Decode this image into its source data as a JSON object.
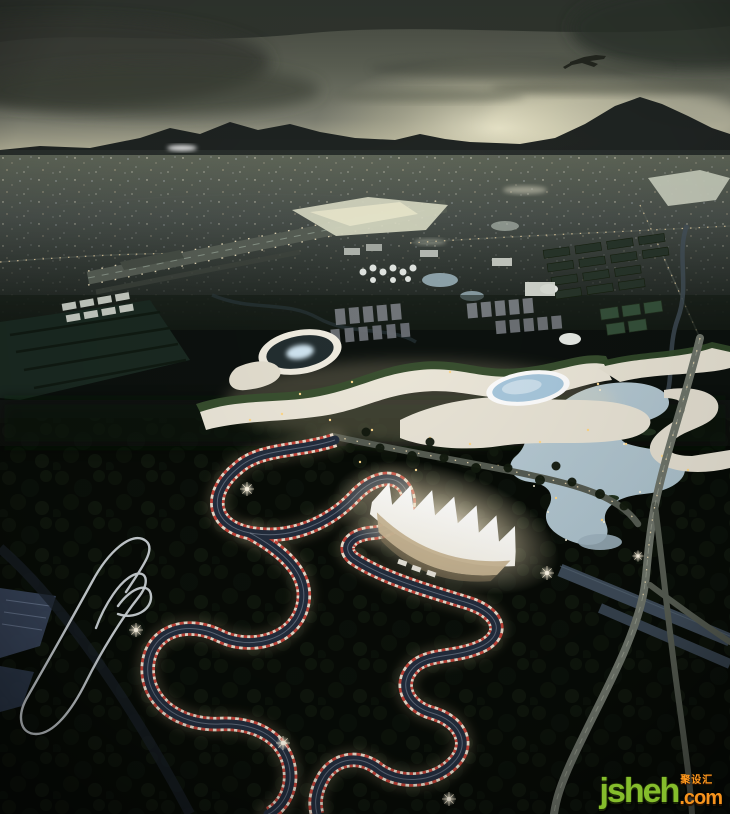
{
  "image": {
    "type": "aerial-architectural-rendering",
    "time_of_day": "dusk",
    "subject": "motorsport-karting-complex"
  },
  "watermark": {
    "brand": "jsheh",
    "tld": ".com",
    "badge": "聚设汇"
  },
  "palette": {
    "sky_top": "#43473f",
    "sky_mid": "#7e8072",
    "horizon_glow": "#e3dfc2",
    "sun_glow": "#f4f0d4",
    "cloud_dark": "#2e332c",
    "mountain": "#191e1d",
    "city_base": "#49504b",
    "city_dark": "#141a16",
    "park_ground": "#070b06",
    "track_asphalt": "#232d3d",
    "curb_red": "#c8453a",
    "curb_white": "#efdfce",
    "track_glow": "#ffe2ae",
    "grandstand_roof": "#f6f3e9",
    "grandstand_glow": "#fff6e0",
    "complex_white": "#ece7d9",
    "complex_green": "#3a5130",
    "skylight_blue": "#a9c9de",
    "lake_blue": "#a9bfca",
    "canal_blue": "#3d4a58",
    "highway_gray": "#6e746a",
    "light_warm": "#ffd98c",
    "watermark_green": "#85bd2c",
    "watermark_orange": "#f7941d"
  }
}
